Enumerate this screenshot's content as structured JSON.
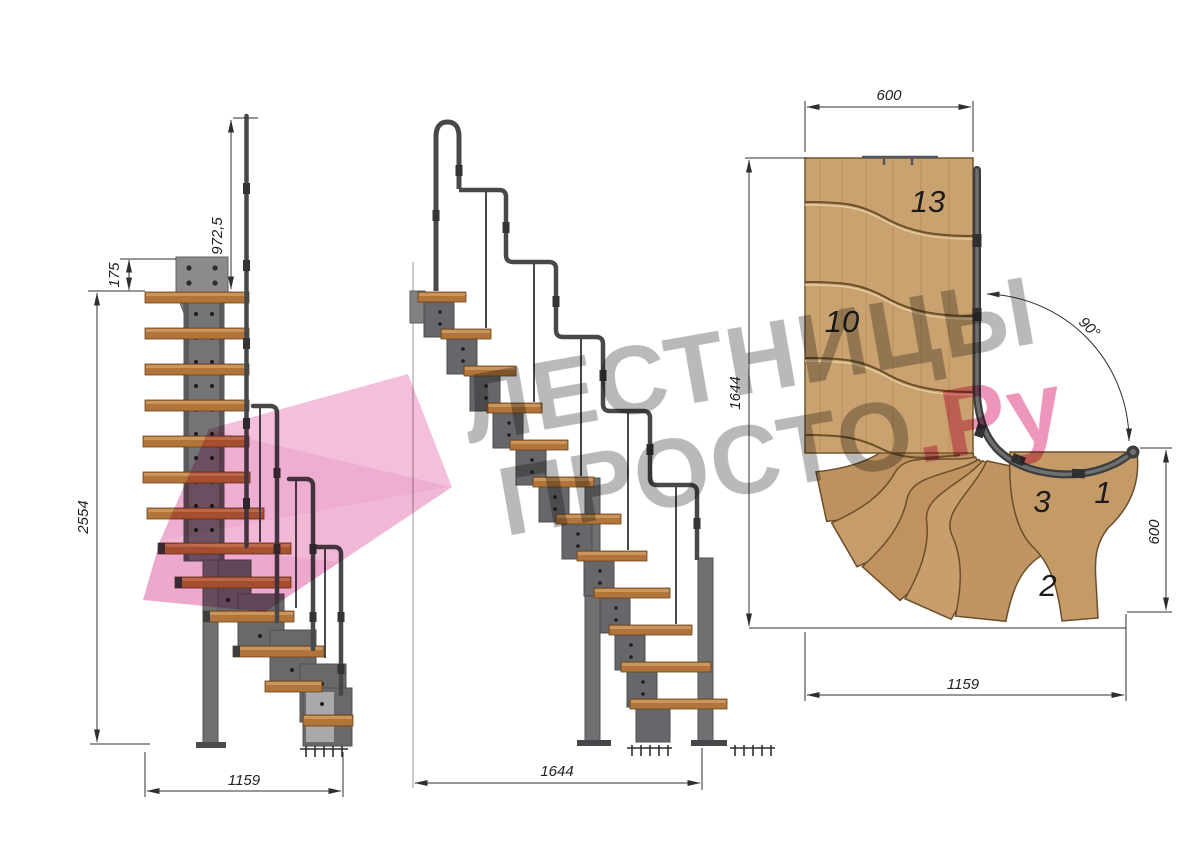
{
  "watermark": {
    "line1": "ЛЕСТНИЦЫ",
    "line2": "ПРОСТО",
    "line2_suffix": ".Ру"
  },
  "front_view": {
    "dim_rail_height": "972,5",
    "dim_plate_offset": "175",
    "dim_total_height": "2554",
    "dim_width": "1159"
  },
  "side_view": {
    "dim_length": "1644"
  },
  "plan_view": {
    "dim_top_width": "600",
    "dim_side_height": "1644",
    "dim_turn_angle": "90°",
    "dim_right_height": "600",
    "dim_bottom_width": "1159",
    "steps": {
      "top": "13",
      "upper": "10",
      "third": "3",
      "first": "1",
      "second": "2"
    }
  },
  "colors": {
    "wood": "#c9a26f",
    "wood_front": "#b1743a",
    "metal": "#737476",
    "rail": "#47484a",
    "dimension": "#2f2f2f",
    "watermark_gray": "#b5b5b5",
    "watermark_pink": "#ee8fb9",
    "arrow_pink": "#f3bcd9"
  }
}
